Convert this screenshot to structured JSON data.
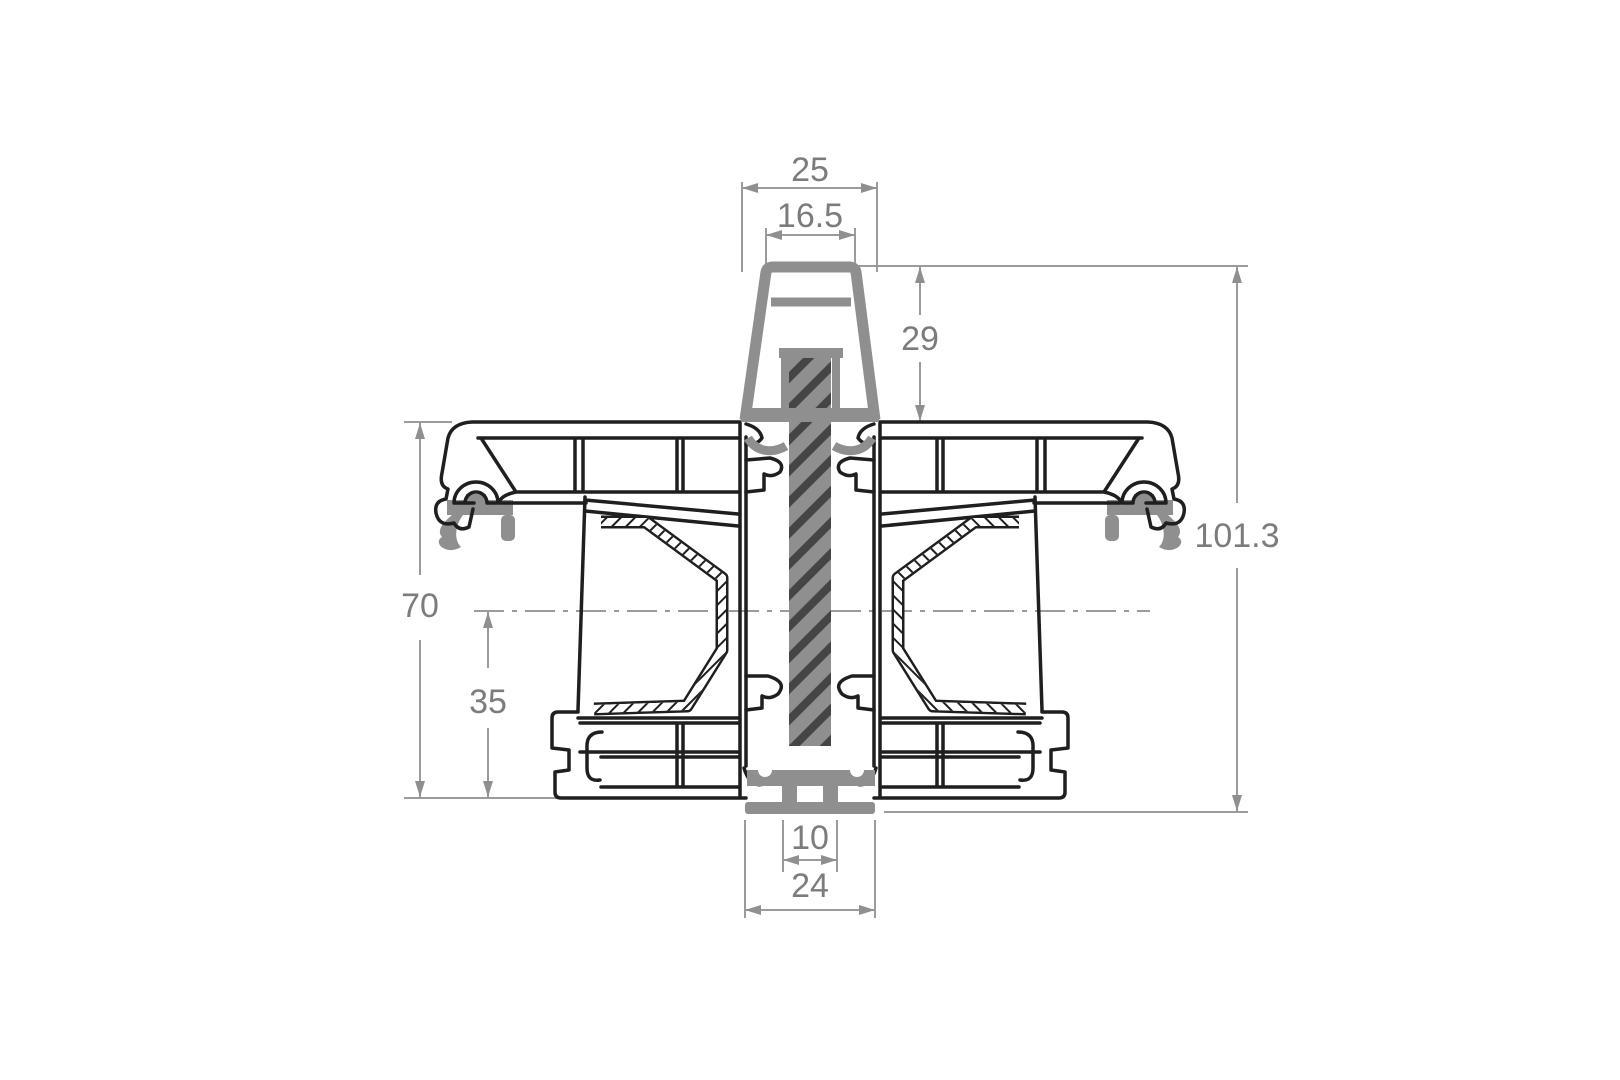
{
  "dimensions": {
    "top_outer_width": "25",
    "top_inner_width": "16.5",
    "gasket_height": "29",
    "total_height": "101.3",
    "frame_height": "70",
    "lower_height": "35",
    "connector_inner_width": "10",
    "connector_outer_width": "24"
  },
  "colors": {
    "background": "#ffffff",
    "outline": "#1f1f1f",
    "gasket": "#8f8f8f",
    "dimension": "#9b9b9b",
    "dimension_text": "#7c7c7c",
    "hatch": "#454545"
  }
}
